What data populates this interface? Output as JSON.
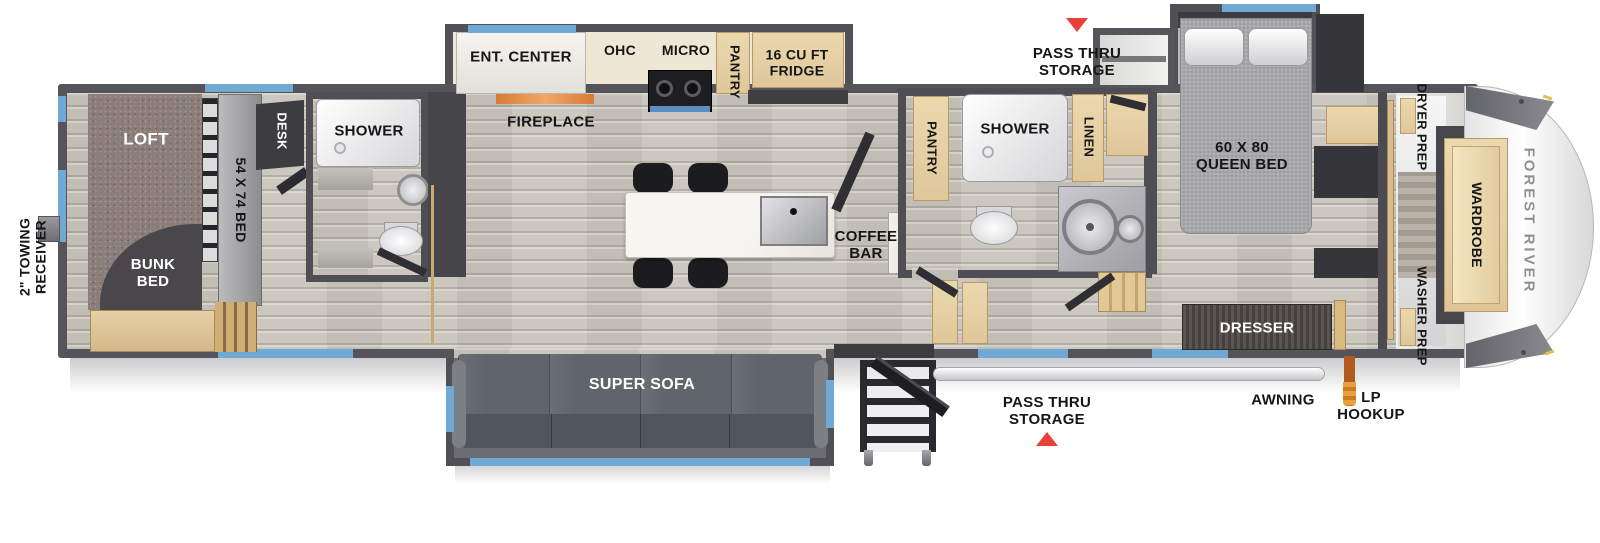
{
  "floorplan": {
    "brand_label": "FOREST RIVER",
    "exterior": {
      "towing": "2\" TOWING RECEIVER",
      "pass_thru_top": "PASS THRU STORAGE",
      "pass_thru_bottom": "PASS THRU STORAGE",
      "awning": "AWNING",
      "lp_hookup": "LP HOOKUP"
    },
    "bunk_room": {
      "loft": "LOFT",
      "bunk_bed": "BUNK BED",
      "bed": "54 X 74 BED",
      "desk": "DESK",
      "shower": "SHOWER"
    },
    "kitchen": {
      "ent_center": "ENT. CENTER",
      "fireplace": "FIREPLACE",
      "ohc": "OHC",
      "micro": "MICRO",
      "pantry": "PANTRY",
      "fridge": "16 CU FT FRIDGE",
      "coffee_bar": "COFFEE BAR"
    },
    "living": {
      "sofa": "SUPER SOFA"
    },
    "bathroom": {
      "pantry": "PANTRY",
      "shower": "SHOWER",
      "linen": "LINEN"
    },
    "bedroom": {
      "bed": "60 X 80 QUEEN BED",
      "dresser": "DRESSER"
    },
    "front_closet": {
      "dryer_prep": "DRYER PREP",
      "washer_prep": "WASHER PREP",
      "wardrobe": "WARDROBE"
    },
    "colors": {
      "window_blue": "#6fa9d4",
      "arrow_red": "#e8403a",
      "lp_orange": "#e08a2e",
      "fireplace_orange": "#e0853c",
      "cabinet_tan": "#e5cfa5",
      "wall_gray": "#54545a",
      "floor_gray": "#ccc8bf",
      "carpet_brown": "#8b7d78"
    }
  }
}
